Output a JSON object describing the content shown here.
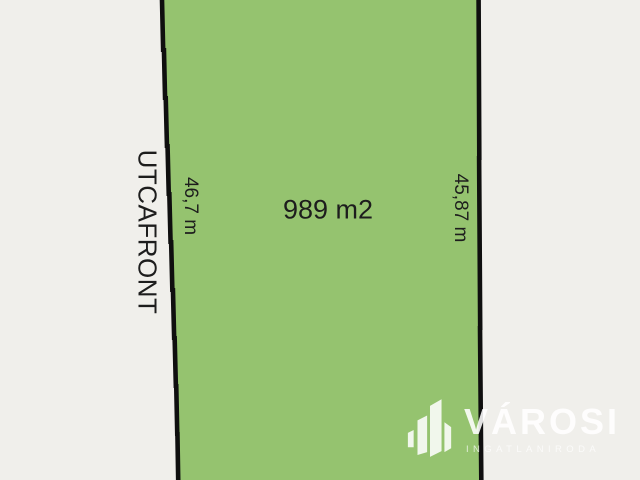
{
  "plot": {
    "area_label": "989 m2",
    "street_front_label": "UTCAFRONT",
    "left_side_length": "46,7 m",
    "right_side_length": "45,87 m"
  },
  "logo": {
    "brand": "VÁROSI",
    "tagline": "INGATLANIRODA",
    "icon": "city-buildings-icon"
  },
  "colors": {
    "background": "#f0efeb",
    "plot_fill": "#95c36f",
    "boundary_line": "#0f0f0f",
    "label_text": "#1d1d1d",
    "logo_white": "#ffffff"
  }
}
